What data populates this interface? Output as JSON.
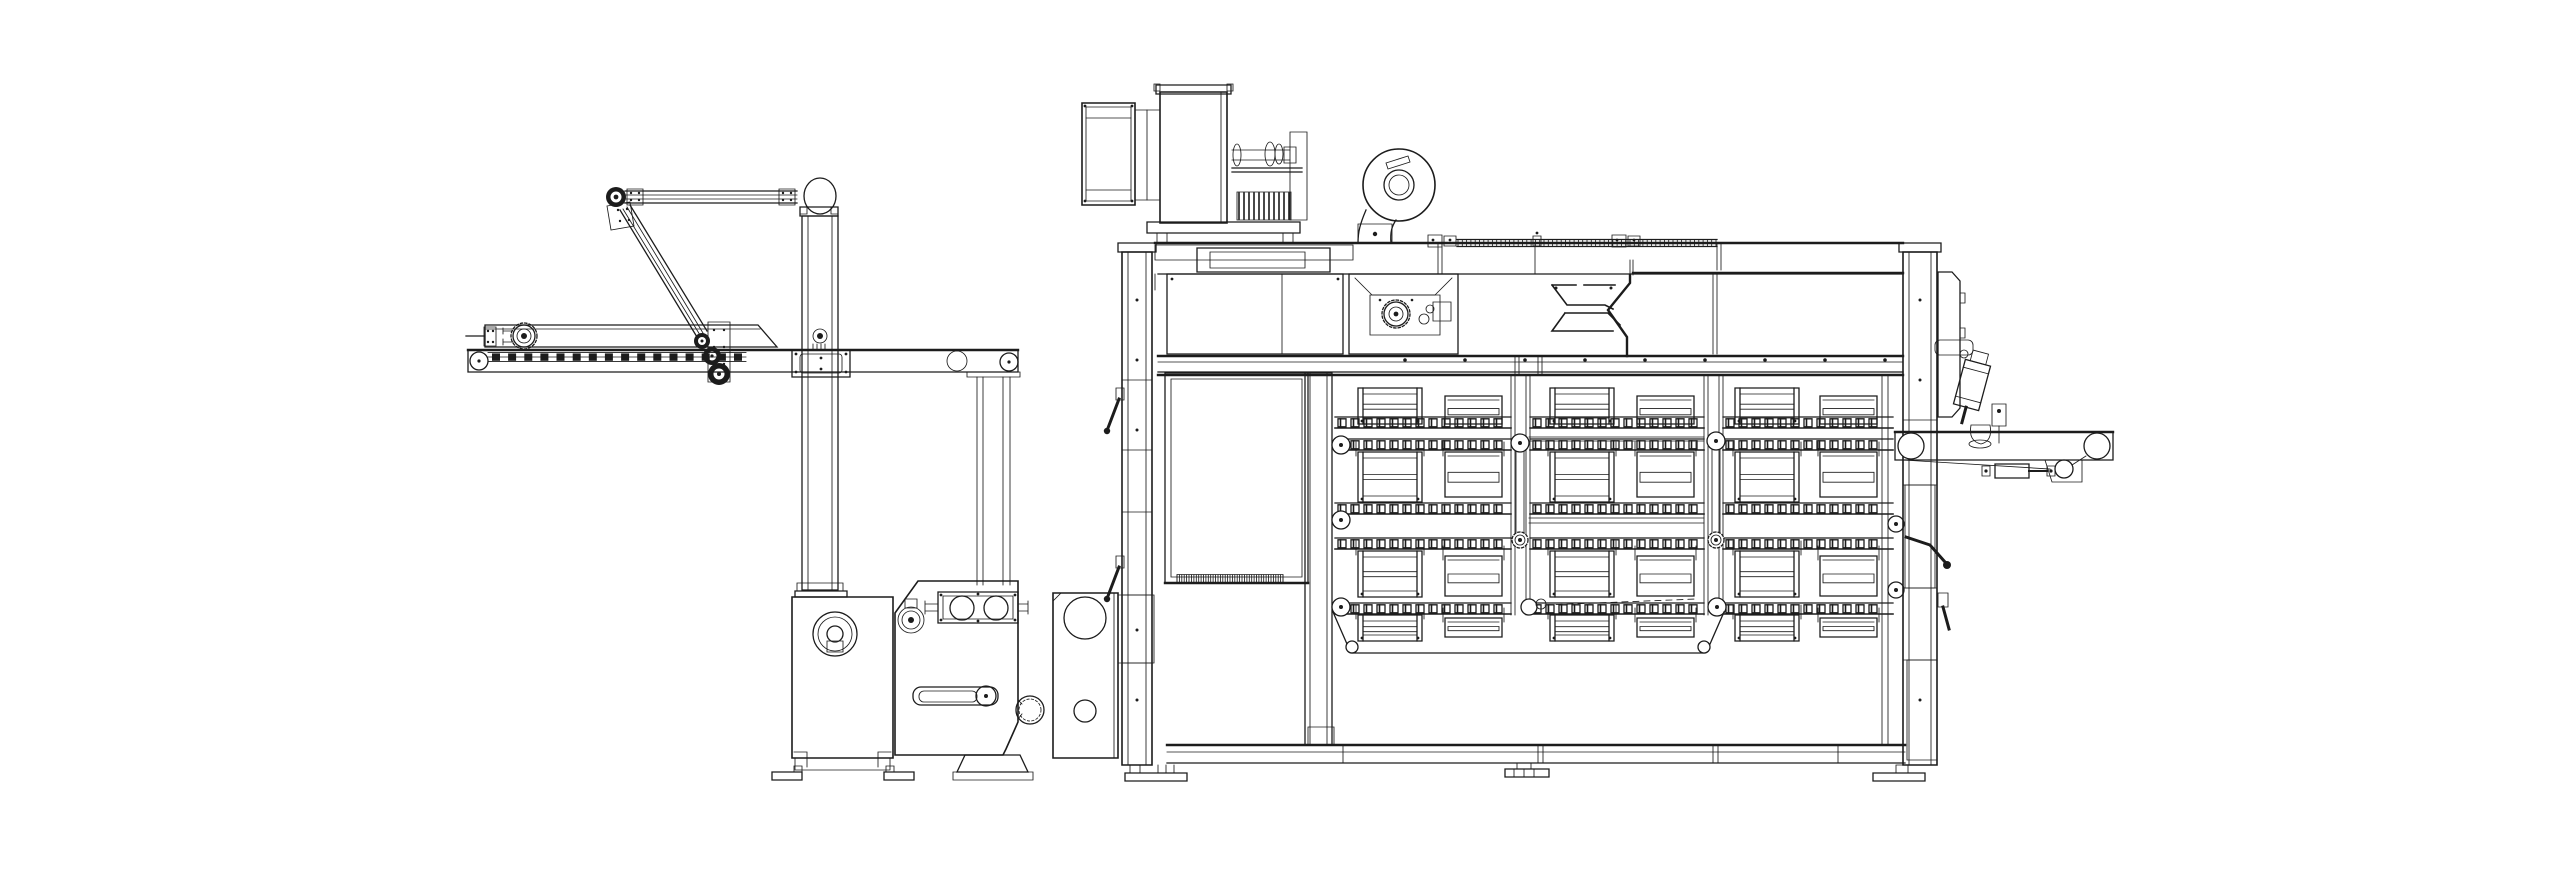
{
  "meta": {
    "title": "Monochrome technical line drawing (side elevation): industrial multi-tier tray proofer with infeed elevator arm and outfeed belt conveyor",
    "background_color": "#ffffff",
    "line_color": "#1c1c1c",
    "canvas_width": 2560,
    "canvas_height": 881
  },
  "diagram": {
    "type": "technical-drawing",
    "style": "cad-outline",
    "view": "side-elevation",
    "machines": [
      {
        "name": "infeed-elevator-unit",
        "parts": [
          "infeed-conveyor",
          "chain-slat-belt",
          "drive-sprocket",
          "transfer-arm",
          "swing-link",
          "head-pulley",
          "support-column",
          "column-bracket",
          "drive-cabinet",
          "gearbox-cabinet",
          "roller-pair",
          "hand-crank",
          "duct-port",
          "wall-bracket-plate",
          "leveling-feet"
        ]
      },
      {
        "name": "tray-proofer-cabinet",
        "parts": [
          "air-filter-box",
          "blower-housing",
          "drive-shaft-assembly",
          "cooling-fins",
          "centrifugal-fan",
          "roof-rail",
          "upper-chamber",
          "distribution-funnel",
          "gearmotor",
          "service-door",
          "door-vent-strip",
          "tray-rack",
          "slat-chains",
          "chain-sprockets",
          "chain-bars",
          "discharge-belt",
          "left-wall",
          "right-wall",
          "latch-levers",
          "base-frame",
          "leveling-feet"
        ]
      },
      {
        "name": "outfeed-unit",
        "parts": [
          "outfeed-conveyor",
          "belt-rollers",
          "press-cylinder",
          "suction-pad",
          "proximity-sensor",
          "belt-return",
          "tension-roller",
          "tension-cylinder",
          "side-panel"
        ]
      }
    ],
    "tray_system": {
      "tiers": 4,
      "bays": 3,
      "trays_per_bay": 2,
      "tray_styles": [
        "tall-rack-tray",
        "low-pan-tray"
      ],
      "slat_chain_bands": 5
    },
    "render_params": {
      "infeed_slat_count": 16,
      "rail_hatch_ticks": 60,
      "door_hatch_ticks": 44,
      "motor_fin_count": 11,
      "beam_bolt_count": 9,
      "slat_pitch": 13,
      "slat_width": 8,
      "slat_height": 8
    }
  }
}
